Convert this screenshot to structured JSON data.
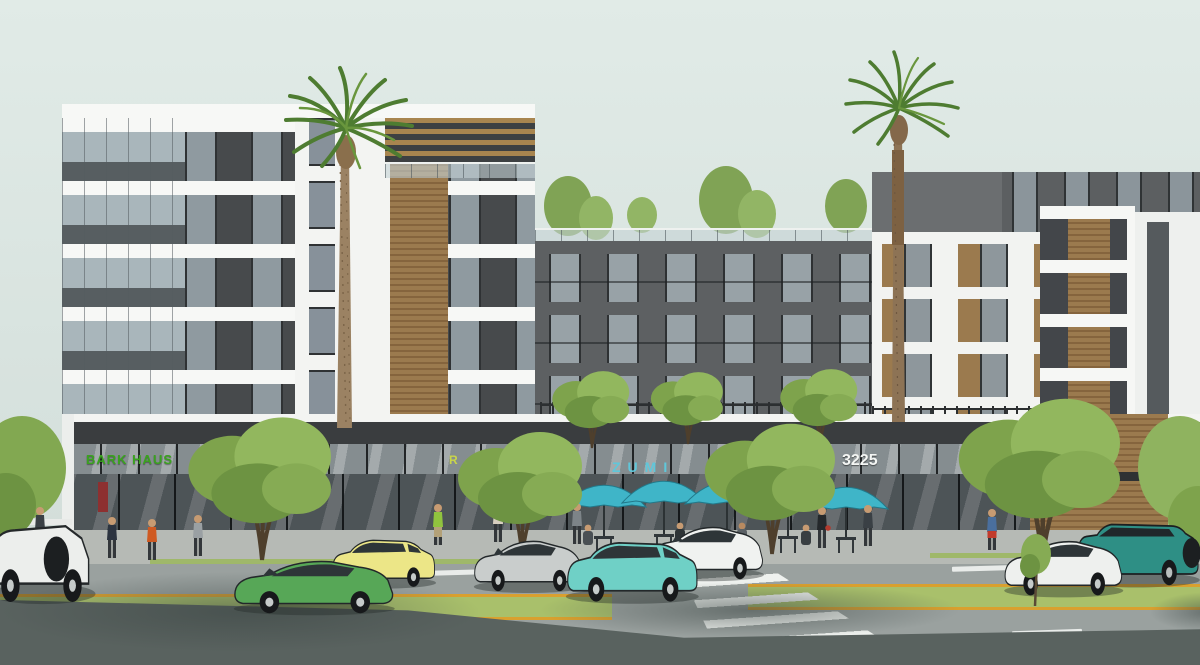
{
  "signs": {
    "left_retail": {
      "text": "BARK HAUS",
      "color": "#3aa21f"
    },
    "left_partial": {
      "text": "R",
      "color": "#c9d54a"
    },
    "center_retail": {
      "text": "ZUMI",
      "color": "#5fc7da"
    },
    "address": {
      "text": "3225",
      "color": "#f4f6f4"
    },
    "corner": {
      "text": "PARKING ENTER",
      "color": "#9fa6a6"
    }
  },
  "palette": {
    "sky": "#dde7e3",
    "facade_dark": "#474a4c",
    "facade_center": "#5d6062",
    "facade_white": "#f2f3f1",
    "wood": "#9b7a4e",
    "window_glass": "#8f9aa0",
    "storefront_glass": "#4d5457",
    "road": "#9aa19f",
    "sidewalk": "#b6bab5",
    "median_grass": "#a9c06b",
    "median_stripe": "#d9a02f",
    "umbrella": "#3fb5c8",
    "tree_green": "#8fb35f",
    "palm_green": "#4e7c31",
    "car_green": "#57a757",
    "car_yellow": "#ece687",
    "car_teal_hatch": "#6fd0c6",
    "car_silver": "#c9cdcc",
    "car_white": "#f0f2f0",
    "suv_teal": "#2e8f85"
  },
  "vehicles": [
    {
      "name": "box-truck",
      "color": "white"
    },
    {
      "name": "sedan",
      "color": "green"
    },
    {
      "name": "wagon",
      "color": "yellow"
    },
    {
      "name": "sedan",
      "color": "silver"
    },
    {
      "name": "sedan",
      "color": "white"
    },
    {
      "name": "hatchback",
      "color": "teal"
    },
    {
      "name": "sedan",
      "color": "white"
    },
    {
      "name": "suv",
      "color": "teal"
    }
  ]
}
